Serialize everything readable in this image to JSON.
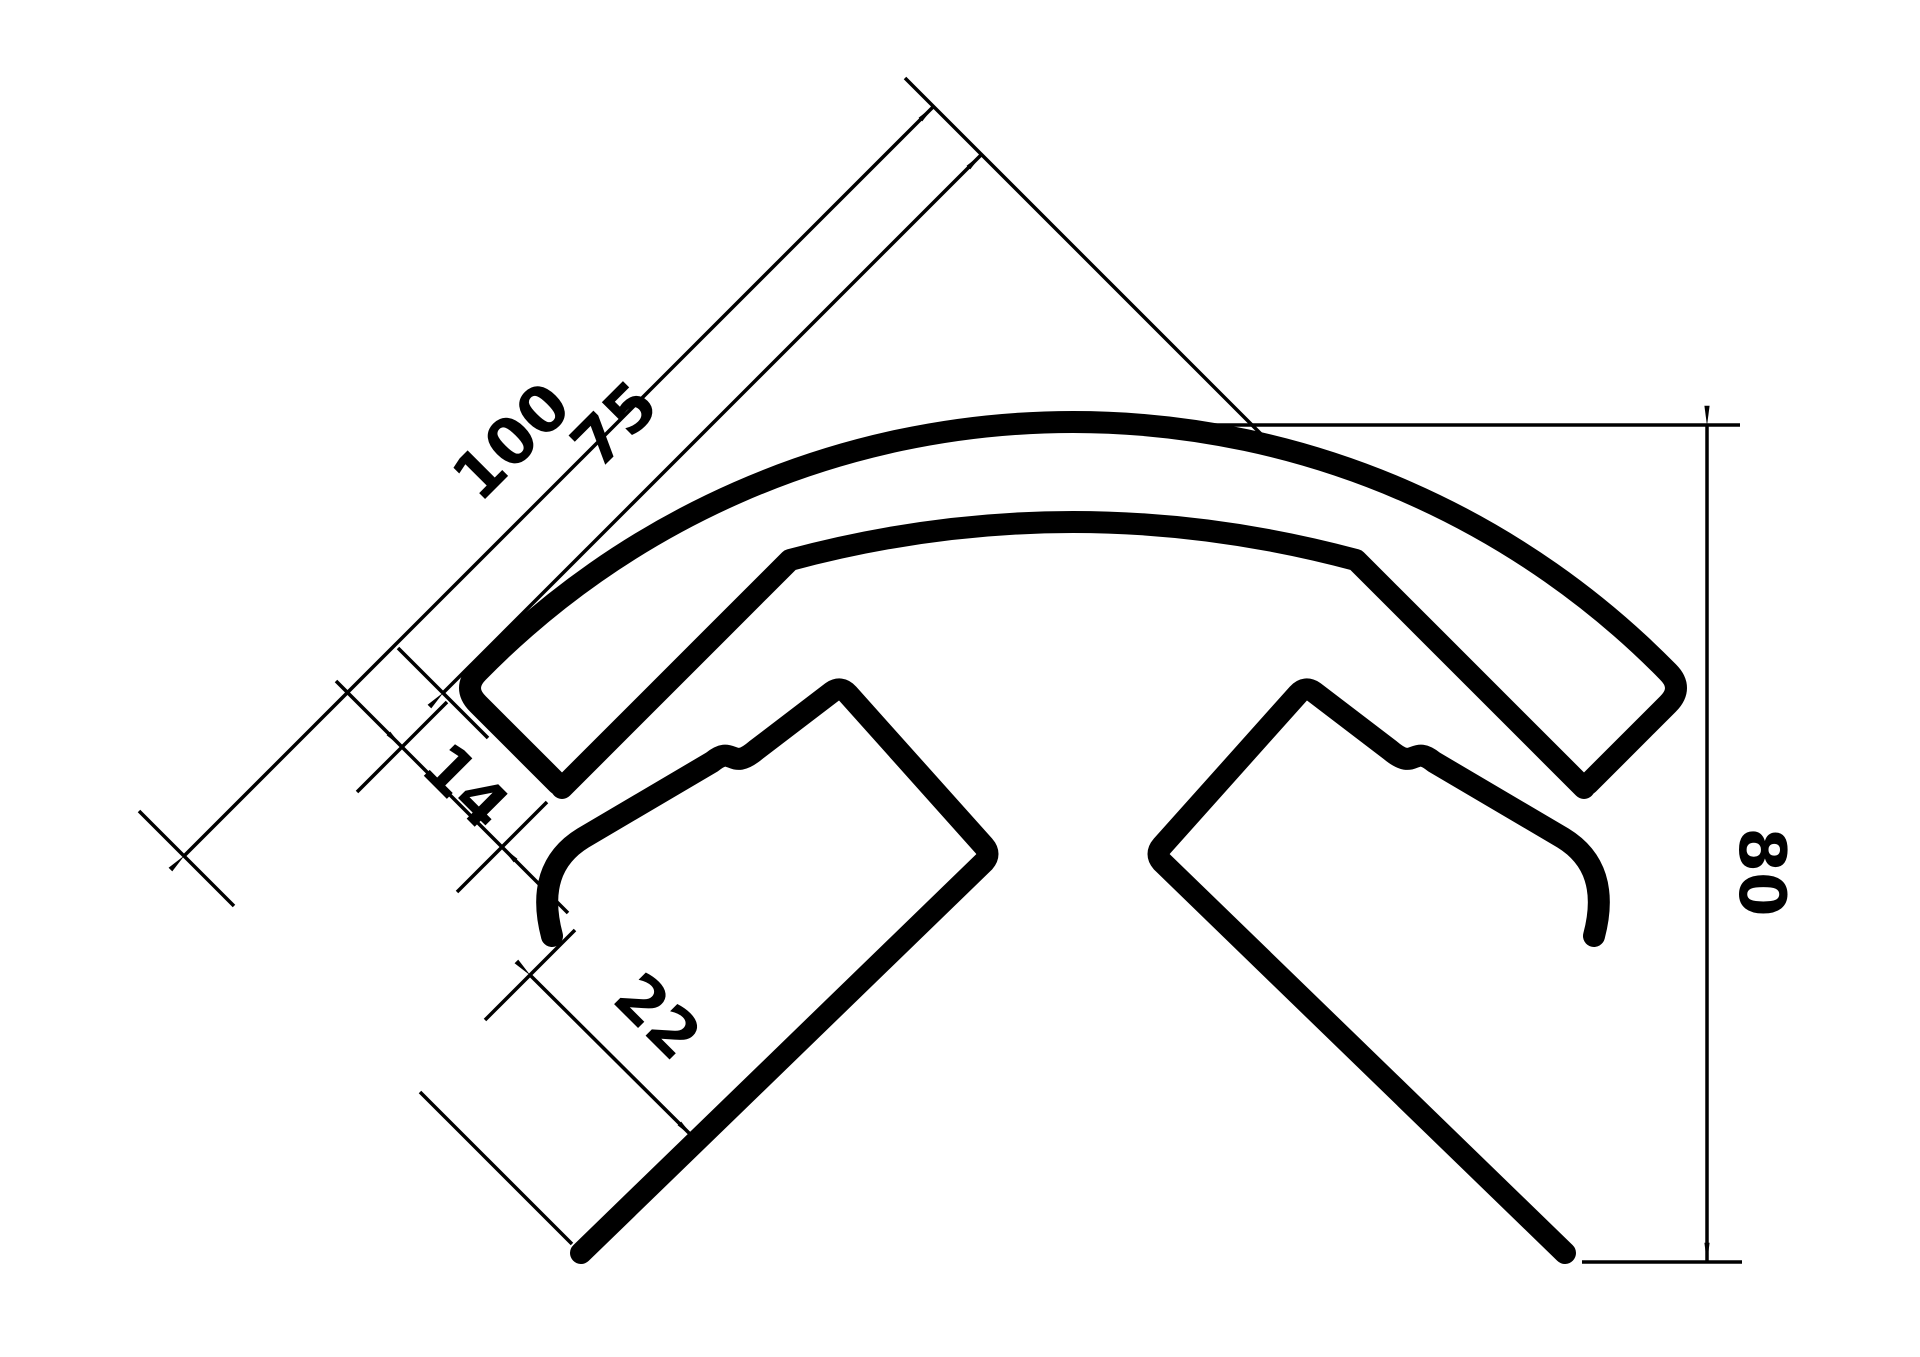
{
  "drawing": {
    "kind": "technical-dimension-drawing",
    "subject": "corner protection profile cross-section",
    "background_color": "#ffffff",
    "line_color": "#000000",
    "units_shown": false
  },
  "dimensions": [
    {
      "id": "dim-100",
      "label": "100",
      "x": 527,
      "y": 457,
      "rot": -45,
      "meaning": "outer leg length"
    },
    {
      "id": "dim-75",
      "label": "75",
      "x": 630,
      "y": 440,
      "rot": -45,
      "meaning": "inner leg length"
    },
    {
      "id": "dim-14",
      "label": "14",
      "x": 450,
      "y": 802,
      "rot": 45,
      "meaning": "upper wall thickness"
    },
    {
      "id": "dim-22",
      "label": "22",
      "x": 642,
      "y": 1032,
      "rot": 45,
      "meaning": "lower wall thickness"
    },
    {
      "id": "dim-80",
      "label": "80",
      "x": 1740,
      "y": 872,
      "rot": 90,
      "meaning": "overall height"
    }
  ]
}
